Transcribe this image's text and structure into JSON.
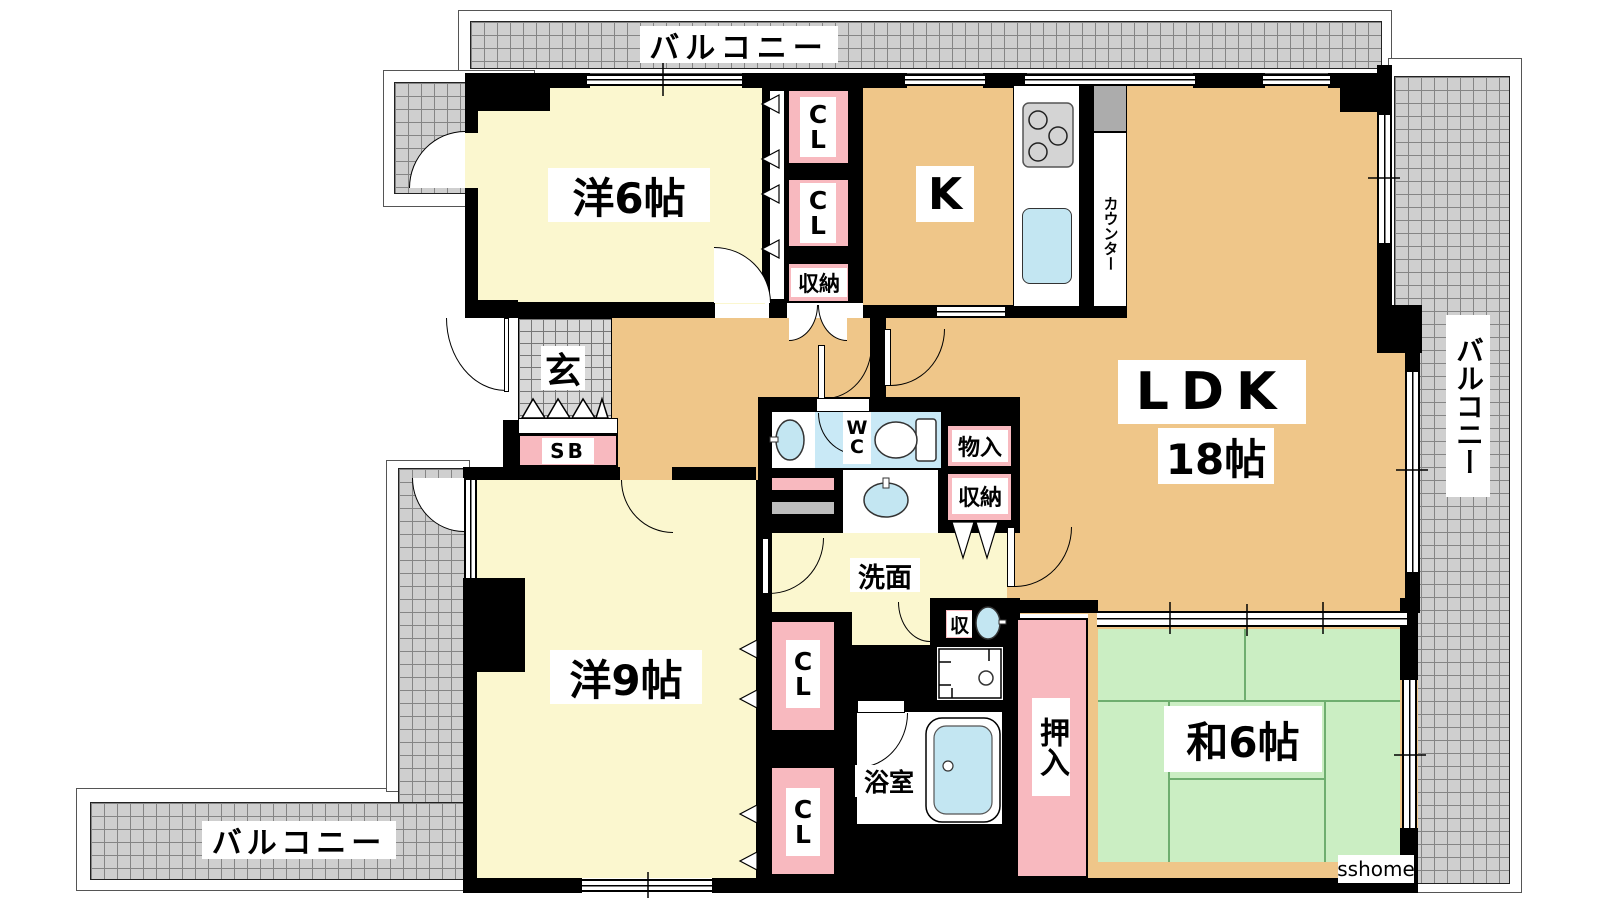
{
  "plan_title": "3LDK apartment floor plan",
  "watermark": "sshome",
  "balcony": {
    "top": "バルコニー",
    "right": "バルコニー",
    "bottom": "バルコニー"
  },
  "rooms": {
    "western6": {
      "label": "洋6帖"
    },
    "kitchen": {
      "label": "K"
    },
    "counter": {
      "label": "カウンター"
    },
    "ldk": {
      "label": "LDK",
      "size": "18帖"
    },
    "japanese6": {
      "label": "和6帖"
    },
    "western9": {
      "label": "洋9帖"
    },
    "entrance": {
      "label": "玄"
    },
    "shoe_box": {
      "label": "SB"
    },
    "washroom": {
      "label": "洗面"
    },
    "bathroom": {
      "label": "浴室"
    },
    "toilet": {
      "label": "WC"
    }
  },
  "storage": {
    "cl_a": "CL",
    "cl_b": "CL",
    "cl_c": "CL",
    "cl_d": "CL",
    "shuno_hall": "収納",
    "shuno_wc": "収納",
    "shu_small": "収",
    "mono_ire": "物入",
    "oshiire": "押入"
  },
  "colors": {
    "wall": "#000000",
    "floor_yellow": "#FBF7CF",
    "floor_tan": "#EFC689",
    "tatami_green": "#CBEEC3",
    "closet_pink": "#F8B9BF",
    "water_blue": "#C3E6F2",
    "hatch_gray": "#CFCFCF",
    "stove_gray": "#D4D4D4"
  }
}
